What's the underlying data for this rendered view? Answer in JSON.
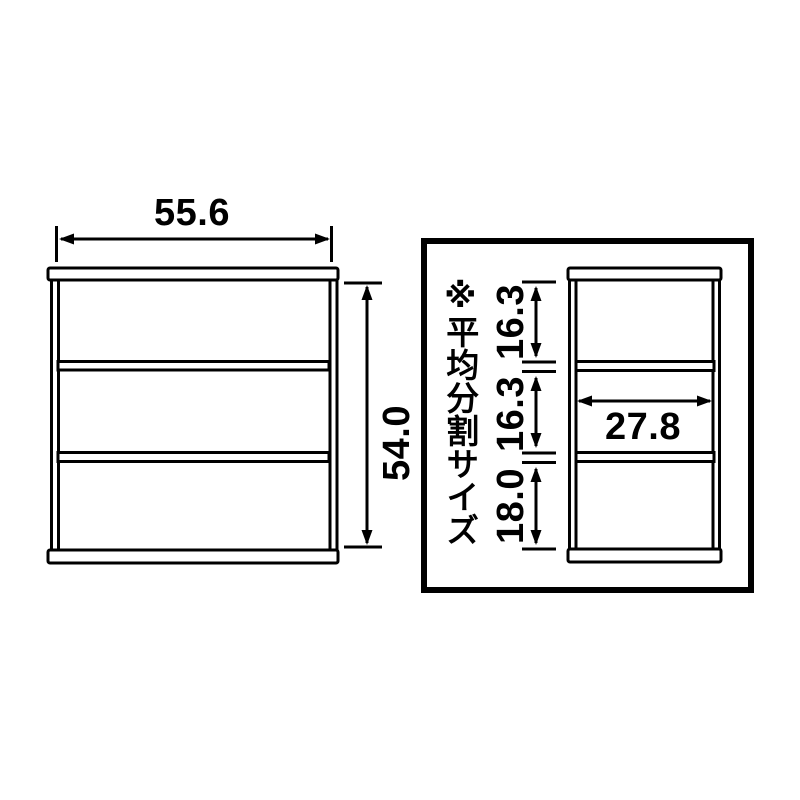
{
  "front_view": {
    "width_label": "55.6",
    "height_label": "54.0"
  },
  "detail_view": {
    "note": "※平均分割サイズ",
    "openings": [
      {
        "label": "16.3"
      },
      {
        "label": "16.3"
      },
      {
        "label": "18.0"
      }
    ],
    "inner_width_label": "27.8"
  },
  "colors": {
    "line": "#000000",
    "background": "#ffffff"
  }
}
